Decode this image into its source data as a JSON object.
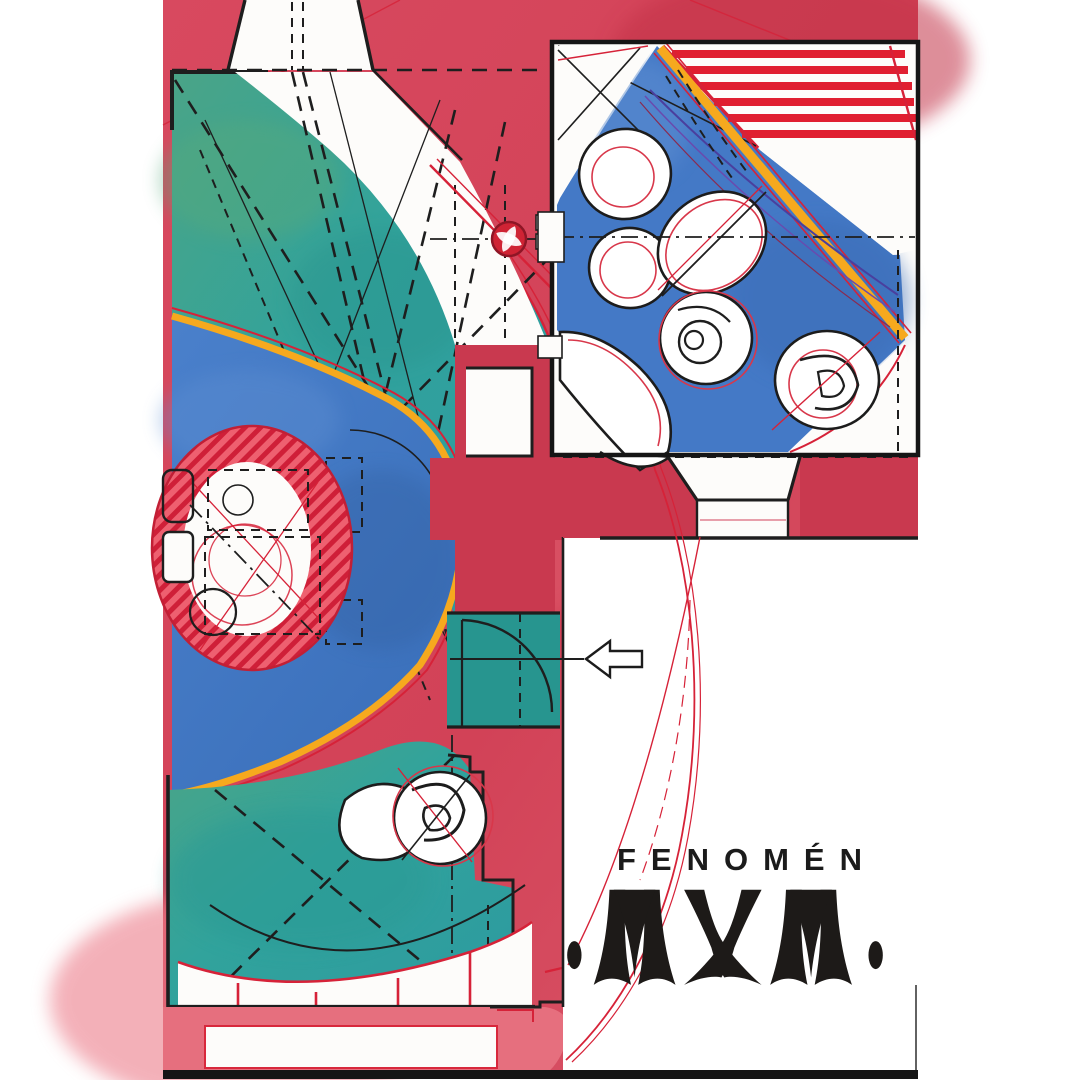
{
  "brand": {
    "title": "FENOMÉN",
    "logo_text": "MXM",
    "logo_full": "·MXM·"
  },
  "palette": {
    "red_field": "#d5495e",
    "red_deep": "#c9394f",
    "pink_light": "#e66f7e",
    "red_ink": "#d62238",
    "stair_red": "#e01f30",
    "teal": "#31a39c",
    "teal_deep": "#27958f",
    "blue": "#4176c2",
    "blue_deep": "#3668b0",
    "blue_room": "#4479c6",
    "yellow": "#f6a91e",
    "ink": "#1b1b1b",
    "purple": "#4a3f9e"
  }
}
